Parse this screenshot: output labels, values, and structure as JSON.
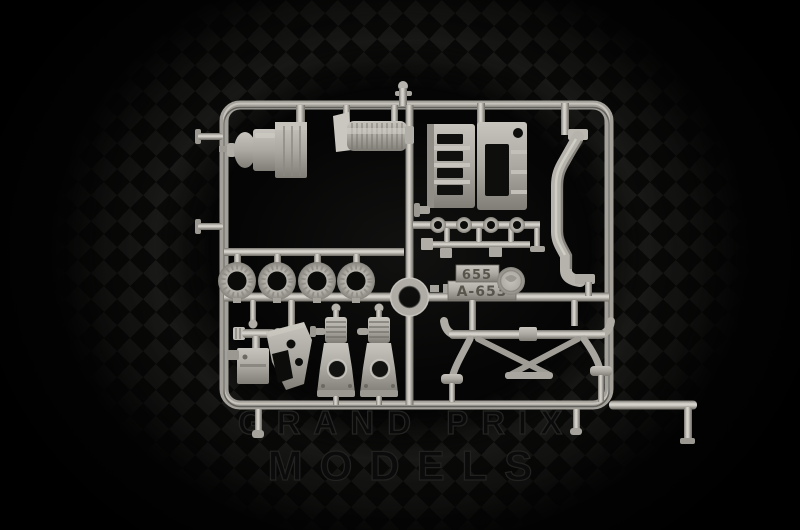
{
  "scene": {
    "description": "Photograph of a grey plastic model-kit sprue on a black checkered-flag background",
    "colors": {
      "background": "#050505",
      "checker_light": "#1b1b19",
      "checker_dark": "#0a0a09",
      "sprue_plastic": "#b3b1a9",
      "sprue_highlight": "#d8d6ce",
      "sprue_shadow": "#6e6c64",
      "watermark_outline": "#242422"
    }
  },
  "watermark": {
    "line1": "GRAND PRIX",
    "line2": "MODELS"
  },
  "sprue": {
    "tag": {
      "line1": "655",
      "line2": "A-653"
    },
    "part_names": [
      "gearbox-assembly",
      "oil-cooler",
      "engine-side-plates",
      "side-wing-blade",
      "intake-trumpet-row",
      "brake-disc",
      "brake-disc",
      "brake-disc",
      "brake-disc",
      "center-ring",
      "part-number-tag",
      "maker-medallion",
      "steering-box",
      "pedal-bracket-plate",
      "suspension-tower",
      "suspension-tower",
      "rear-subframe"
    ]
  }
}
